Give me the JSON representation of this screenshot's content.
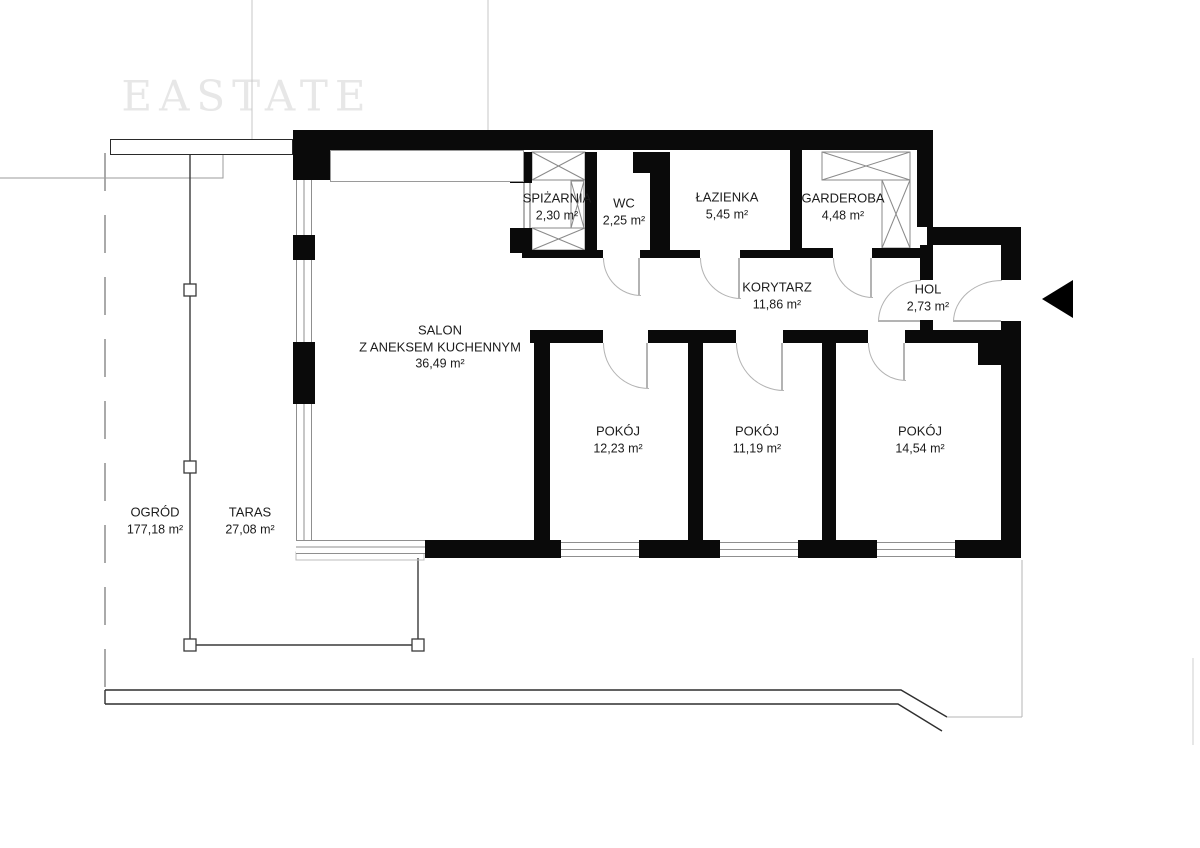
{
  "watermark": "EASTATE",
  "rooms": [
    {
      "id": "salon",
      "name": "SALON",
      "name2": "Z ANEKSEM KUCHENNYM",
      "area": "36,49 m²"
    },
    {
      "id": "spizarnia",
      "name": "SPIŻARNIA",
      "area": "2,30 m²"
    },
    {
      "id": "wc",
      "name": "WC",
      "area": "2,25 m²"
    },
    {
      "id": "lazienka",
      "name": "ŁAZIENKA",
      "area": "5,45 m²"
    },
    {
      "id": "garderoba",
      "name": "GARDEROBA",
      "area": "4,48 m²"
    },
    {
      "id": "korytarz",
      "name": "KORYTARZ",
      "area": "11,86 m²"
    },
    {
      "id": "hol",
      "name": "HOL",
      "area": "2,73 m²"
    },
    {
      "id": "pokoj1",
      "name": "POKÓJ",
      "area": "12,23 m²"
    },
    {
      "id": "pokoj2",
      "name": "POKÓJ",
      "area": "11,19 m²"
    },
    {
      "id": "pokoj3",
      "name": "POKÓJ",
      "area": "14,54 m²"
    },
    {
      "id": "taras",
      "name": "TARAS",
      "area": "27,08 m²"
    },
    {
      "id": "ogrod",
      "name": "OGRÓD",
      "area": "177,18 m²"
    }
  ],
  "icons": {
    "entrance": "left-arrow"
  },
  "colors": {
    "wall": "#0a0a0a",
    "thin_line": "#8f8f8f",
    "door_arc": "#b3b3b3",
    "text": "#1c1c1c",
    "watermark": "#e7e7e7"
  }
}
